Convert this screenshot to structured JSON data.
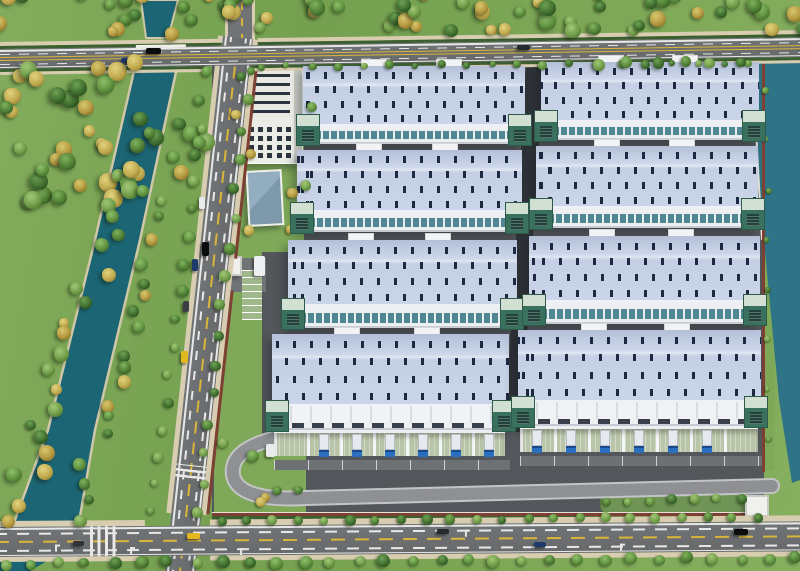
{
  "scene": {
    "description": "aerial 3d rendering of a logistics industrial park with eight warehouses, office tower, canal, river and tree lined roads",
    "palette": {
      "grass": "#7da756",
      "lawn": "#7fa958",
      "lawn_strip": "#6f9455",
      "water_canal": "#1b6574",
      "water_river": "#2e7386",
      "bank": "#cfc7a8",
      "asphalt": "#717476",
      "asphalt_dark": "#67696b",
      "sidewalk": "#d8cdb0",
      "hedge": "#3c5f31",
      "lane_white": "#e8e8e8",
      "lane_yellow": "#d9b53a",
      "wall_red": "#7d4032",
      "wall_trim": "#e8e4da",
      "park_ground": "#53565a",
      "alley": "#2e3338",
      "apron": "#6e7174",
      "ramp_edge": "#c3c4c6",
      "ramp_deck": "#8e9093",
      "roof_base": "#cbd5e9",
      "roof_grad": "#b4bed6",
      "roof_light": "#e0e6f3",
      "skylight": "#1d2940",
      "eave": "#eef2f8",
      "facade": "#edeff3",
      "facade_shadow": "#c6cad2",
      "window_teal": "#4f8792",
      "dock_face_a": "#f0f2f5",
      "dock_face_b": "#d9dce2",
      "dock_door": "#39404c",
      "canopy_floor": "#b9c5a8",
      "canopy_wall": "#f4f5f7",
      "tower_cap": "#d2e0d4",
      "tower_body": "#39705e",
      "tower_slit": "#20423a",
      "tower_edge": "#2e5a4a",
      "penthouse": "#f2f3f5",
      "office_wall": "#ecece6",
      "office_roof": "#e7e9e2",
      "office_window": "#2c3440",
      "office_side": "#c9cbc3",
      "small_roof": "#7e99ac",
      "gatehouse": "#f0f1ee",
      "gatehouse_roof": "#c8cac4",
      "truck_cab": "#2a6fc0",
      "truck_cab_dark": "#174a8c",
      "trailer": "#e6eaef",
      "parking_pad": "#9fb98a"
    },
    "tree_colors": [
      [
        "#8fc06a",
        "#5d8f3e",
        "#33561f"
      ],
      [
        "#7fb35e",
        "#4e7d33",
        "#2a4a1b"
      ],
      [
        "#a3c877",
        "#6f9c48",
        "#3f6322"
      ],
      [
        "#6da254",
        "#3f6d2e",
        "#1f3d14"
      ],
      [
        "#e2d37e",
        "#c0a94e",
        "#7d6a25"
      ],
      [
        "#d8c86e",
        "#b3973f",
        "#6e5c1e"
      ]
    ],
    "green_color_count": 4,
    "tree_regions": [
      {
        "name": "top-belt",
        "type": "rect",
        "x": -8,
        "y": -6,
        "w": 816,
        "h": 40,
        "n": 64,
        "smin": 10,
        "smax": 17,
        "greens_only": false
      },
      {
        "name": "left-forest",
        "type": "rect",
        "x": 0,
        "y": 58,
        "w": 208,
        "h": 145,
        "n": 48,
        "smin": 11,
        "smax": 19,
        "greens_only": false
      },
      {
        "name": "canal-west-bank",
        "type": "line",
        "x1": 118,
        "y1": 205,
        "x2": 14,
        "y2": 515,
        "j": 16,
        "n": 20,
        "smin": 10,
        "smax": 16,
        "greens_only": false
      },
      {
        "name": "canal-east-bank",
        "type": "line",
        "x1": 158,
        "y1": 205,
        "x2": 78,
        "y2": 515,
        "j": 14,
        "n": 18,
        "smin": 9,
        "smax": 15,
        "greens_only": false
      },
      {
        "name": "left-road-west-trees",
        "type": "line",
        "x1": 206,
        "y1": 72,
        "x2": 152,
        "y2": 512,
        "j": 4,
        "n": 17,
        "smin": 8,
        "smax": 12,
        "greens_only": true
      },
      {
        "name": "left-road-east-trees",
        "type": "line",
        "x1": 250,
        "y1": 72,
        "x2": 198,
        "y2": 512,
        "j": 4,
        "n": 16,
        "smin": 8,
        "smax": 12,
        "greens_only": true
      },
      {
        "name": "top-road-verge-bushes",
        "type": "line",
        "x1": 262,
        "y1": 66,
        "x2": 750,
        "y2": 63,
        "j": 2,
        "n": 20,
        "smin": 6,
        "smax": 9,
        "greens_only": true
      },
      {
        "name": "north-park-trees",
        "type": "line",
        "x1": 600,
        "y1": 64,
        "x2": 740,
        "y2": 62,
        "j": 3,
        "n": 6,
        "smin": 9,
        "smax": 12,
        "greens_only": true
      },
      {
        "name": "bottom-wall-trees",
        "type": "line",
        "x1": 222,
        "y1": 521,
        "x2": 758,
        "y2": 517,
        "j": 2,
        "n": 22,
        "smin": 8,
        "smax": 11,
        "greens_only": true
      },
      {
        "name": "bottom-south-trees",
        "type": "line",
        "x1": 4,
        "y1": 564,
        "x2": 796,
        "y2": 558,
        "j": 3,
        "n": 30,
        "smin": 9,
        "smax": 13,
        "greens_only": true
      },
      {
        "name": "office-lawn-trees",
        "type": "rect",
        "x": 224,
        "y": 66,
        "w": 90,
        "h": 170,
        "n": 9,
        "smin": 7,
        "smax": 11,
        "greens_only": false
      },
      {
        "name": "yard-strip-trees",
        "type": "line",
        "x1": 608,
        "y1": 502,
        "x2": 740,
        "y2": 498,
        "j": 3,
        "n": 7,
        "smin": 8,
        "smax": 10,
        "greens_only": true
      },
      {
        "name": "corner-lawn-trees",
        "type": "rect",
        "x": 218,
        "y": 440,
        "w": 85,
        "h": 70,
        "n": 6,
        "smin": 8,
        "smax": 12,
        "greens_only": false
      },
      {
        "name": "east-wall-bushes",
        "type": "line",
        "x1": 767,
        "y1": 90,
        "x2": 767,
        "y2": 440,
        "j": 2,
        "n": 8,
        "smin": 5,
        "smax": 7,
        "greens_only": true
      }
    ],
    "warehouses": [
      {
        "id": "a1",
        "x": 303,
        "y": 66,
        "w": 222,
        "roof_h": 60,
        "facade_h": 18,
        "docks": false,
        "trucks": []
      },
      {
        "id": "b1",
        "x": 541,
        "y": 62,
        "w": 218,
        "roof_h": 60,
        "facade_h": 18,
        "docks": false,
        "trucks": []
      },
      {
        "id": "a2",
        "x": 297,
        "y": 150,
        "w": 225,
        "roof_h": 62,
        "facade_h": 20,
        "docks": false,
        "trucks": []
      },
      {
        "id": "b2",
        "x": 536,
        "y": 146,
        "w": 222,
        "roof_h": 62,
        "facade_h": 20,
        "docks": false,
        "trucks": []
      },
      {
        "id": "a3",
        "x": 288,
        "y": 240,
        "w": 229,
        "roof_h": 66,
        "facade_h": 22,
        "docks": false,
        "trucks": []
      },
      {
        "id": "b3",
        "x": 529,
        "y": 236,
        "w": 231,
        "roof_h": 66,
        "facade_h": 22,
        "docks": false,
        "trucks": []
      },
      {
        "id": "a4",
        "x": 272,
        "y": 334,
        "w": 237,
        "roof_h": 72,
        "facade_h": 24,
        "docks": true,
        "trucks": [
          1,
          2,
          3,
          4,
          5,
          6
        ]
      },
      {
        "id": "b4",
        "x": 518,
        "y": 330,
        "w": 243,
        "roof_h": 72,
        "facade_h": 24,
        "docks": true,
        "trucks": [
          0,
          1,
          2,
          3,
          4,
          5
        ]
      }
    ],
    "office": {
      "x": 243,
      "y": 64,
      "w": 60,
      "h": 100,
      "roof_ratio": 0.55,
      "win_rows": 4,
      "win_cols": 5
    },
    "small_building": {
      "x": 247,
      "y": 170,
      "w": 36,
      "h": 56
    },
    "gatehouses": [
      {
        "x": 221,
        "y": 256,
        "w": 21,
        "h": 20
      },
      {
        "x": 745,
        "y": 495,
        "w": 24,
        "h": 22
      }
    ],
    "parking_pad": {
      "x": 242,
      "y": 270,
      "w": 20,
      "h": 50
    },
    "driveway": {
      "x": 204,
      "y": 258,
      "w": 62,
      "h": 34
    },
    "aprons": [
      {
        "x": 274,
        "y": 460,
        "w": 236,
        "h": 10
      },
      {
        "x": 520,
        "y": 456,
        "w": 242,
        "h": 10
      }
    ],
    "walls": {
      "top": {
        "x": 250,
        "y": 60,
        "w": 508,
        "h": 3
      },
      "east": {
        "x": 762,
        "y": 60,
        "w": 3,
        "h": 412
      },
      "bottom": {
        "x": 212,
        "y": 512,
        "w": 552,
        "h": 4
      },
      "bottom_hedge": {
        "x": 212,
        "y": 516,
        "w": 552,
        "h": 5
      }
    },
    "park_bg": {
      "x": 212,
      "y": 60,
      "w": 552,
      "h": 458
    },
    "lawns": [
      {
        "name": "office-lawn",
        "x": 220,
        "y": 62,
        "w": 84,
        "h": 190
      },
      {
        "name": "west-lawn",
        "x": 216,
        "y": 250,
        "w": 46,
        "h": 196
      },
      {
        "name": "corner-lawn",
        "x": 214,
        "y": 444,
        "w": 92,
        "h": 70
      },
      {
        "name": "east-lawn-strip",
        "x": 765,
        "y": 62,
        "w": 10,
        "h": 408
      }
    ],
    "yard_green_strip": {
      "x": 600,
      "y": 490,
      "w": 148,
      "h": 24
    },
    "roads": {
      "top": {
        "y": 42,
        "h": 33,
        "tilt": -0.85,
        "asphalt_top": 7,
        "asphalt_h": 20,
        "bridge_x1": 136,
        "bridge_x2": 186
      },
      "left": {
        "x": 218,
        "top": 38,
        "w": 46,
        "len": 545,
        "tilt": 6.2
      },
      "bottom": {
        "x": -5,
        "y": 521,
        "w": 812,
        "tilt": -0.4,
        "asphalt_top": 6,
        "asphalt_h": 30,
        "zebra_x": 95
      },
      "north_stub": {
        "x": 225,
        "y": 0,
        "w": 30,
        "h": 42
      }
    },
    "svg_shapes": {
      "canal_upper": "M141,0 L178,0 L168,38 L146,38 Z",
      "canal_main": "M137,58 L179,58 L140,240 L95,430 L78,528 L12,528 L48,430 L95,240 Z",
      "canal_corner": "M0,558 L52,558 L30,571 L0,571 Z",
      "river": "M754,58 L800,58 L800,480 L792,483 L779,400 L763,230 L755,120 Z",
      "quay": "M754,60 L757,150 L762,240",
      "alley": "M526,62 L544,62 L521,432 L505,432 Z",
      "ramp": "M318,432 C266,436 236,448 233,468 C230,490 254,501 306,498 L772,486"
    },
    "cars": [
      {
        "x": 146,
        "y": 48,
        "w": 15,
        "h": 6,
        "color": "#0b0b0d"
      },
      {
        "x": 121,
        "y": 58,
        "w": 12,
        "h": 5,
        "color": "#1d3a6b"
      },
      {
        "x": 517,
        "y": 45,
        "w": 13,
        "h": 5,
        "color": "#26292f"
      },
      {
        "x": 199,
        "y": 197,
        "w": 6,
        "h": 12,
        "color": "#e9eaec"
      },
      {
        "x": 202,
        "y": 242,
        "w": 7,
        "h": 14,
        "color": "#0c0d0f"
      },
      {
        "x": 192,
        "y": 259,
        "w": 6,
        "h": 12,
        "color": "#1d3a6b"
      },
      {
        "x": 183,
        "y": 301,
        "w": 6,
        "h": 11,
        "color": "#3a3e44"
      },
      {
        "x": 181,
        "y": 351,
        "w": 7,
        "h": 12,
        "color": "#e2b81f"
      },
      {
        "x": 254,
        "y": 256,
        "w": 11,
        "h": 20,
        "color": "#eceef0"
      },
      {
        "x": 266,
        "y": 444,
        "w": 9,
        "h": 13,
        "color": "#e8eaec"
      },
      {
        "x": 187,
        "y": 533,
        "w": 13,
        "h": 6,
        "color": "#e2b81f"
      },
      {
        "x": 437,
        "y": 529,
        "w": 12,
        "h": 5,
        "color": "#26292f"
      },
      {
        "x": 534,
        "y": 542,
        "w": 12,
        "h": 5,
        "color": "#1d3a6b"
      },
      {
        "x": 734,
        "y": 529,
        "w": 14,
        "h": 6,
        "color": "#0b0b0d"
      },
      {
        "x": 73,
        "y": 541,
        "w": 11,
        "h": 5,
        "color": "#2f3338"
      }
    ]
  }
}
